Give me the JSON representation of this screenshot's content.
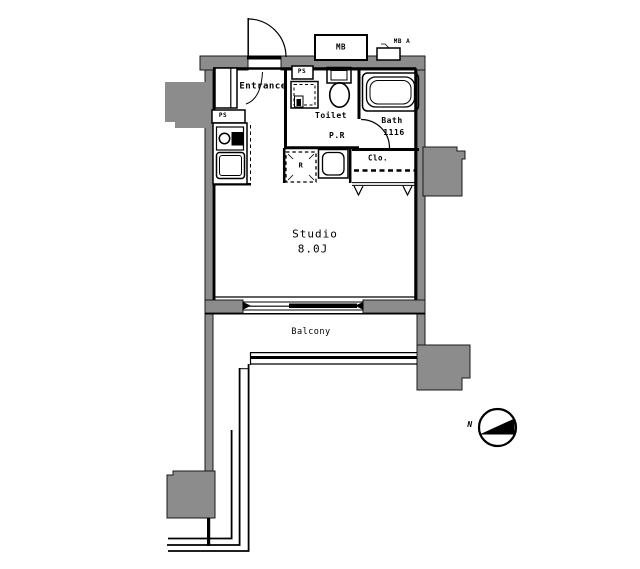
{
  "plan": {
    "title": "studio-apartment-floor-plan",
    "rooms": {
      "entrance": "Entrance",
      "toilet": "Toilet",
      "powder_room": "P.R",
      "bath": "Bath",
      "bath_module_size": "1116",
      "closet": "Clo.",
      "studio": "Studio",
      "studio_size": "8.0J",
      "balcony": "Balcony"
    },
    "labels": {
      "meter_box": "MB",
      "pipe_shaft_top": "PS",
      "pipe_shaft_kitchen": "PS",
      "refrigerator_space": "R",
      "wall_sleeve": "MB A",
      "north": "N"
    },
    "colors": {
      "wall_gray": "#8c8c8c",
      "line_black": "#000000",
      "background": "#ffffff"
    }
  }
}
